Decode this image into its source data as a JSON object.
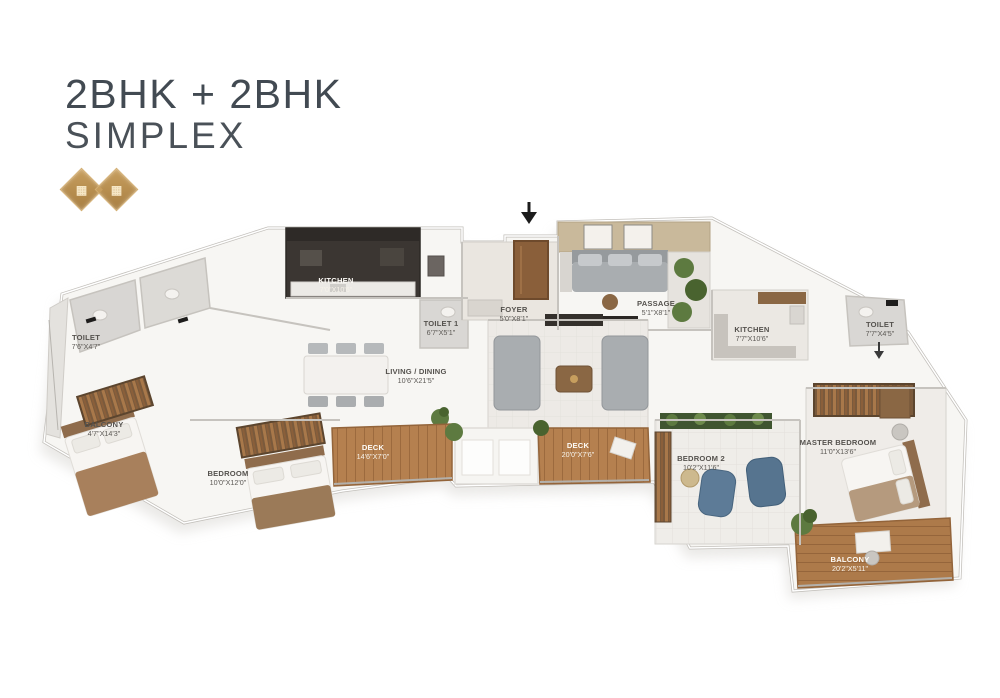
{
  "header": {
    "title_line1": "2BHK + 2BHK",
    "title_line2": "SIMPLEX",
    "badges": {
      "left_glyph": "▦",
      "separator": "◆",
      "right_glyph": "▦"
    }
  },
  "colors": {
    "title_text": "#424a52",
    "badge_gold": "#b18a4e",
    "deck_wood": "#b5804f",
    "kitchen_dark": "#3b3632",
    "wall_gray": "#c6c3be",
    "plant_green": "#5d7a40",
    "chair_blue": "#5d7b97",
    "door_brown": "#8a5f3a"
  },
  "floorplan": {
    "labels": {
      "toilet_l": {
        "name": "TOILET",
        "dim": "7'6\"X4'7\""
      },
      "balcony_l": {
        "name": "BALCONY",
        "dim": "4'7\"X14'3\""
      },
      "kitchen_l": {
        "name": "KITCHEN",
        "dim": "7'0\"X10'6\""
      },
      "toilet1": {
        "name": "TOILET 1",
        "dim": "6'7\"X5'1\""
      },
      "living_dining_l": {
        "name": "LIVING / DINING",
        "dim": "10'6\"X21'5\""
      },
      "bedroom_l": {
        "name": "BEDROOM",
        "dim": "10'0\"X12'0\""
      },
      "deck_l": {
        "name": "DECK",
        "dim": "14'6\"X7'0\""
      },
      "foyer": {
        "name": "FOYER",
        "dim": "5'0\"X8'1\""
      },
      "passage": {
        "name": "PASSAGE",
        "dim": "5'1\"X8'1\""
      },
      "deck_c": {
        "name": "DECK",
        "dim": "20'0\"X7'6\""
      },
      "kitchen_r": {
        "name": "KITCHEN",
        "dim": "7'7\"X10'6\""
      },
      "toilet_r": {
        "name": "TOILET",
        "dim": "7'7\"X4'5\""
      },
      "bedroom_r": {
        "name": "BEDROOM 2",
        "dim": "10'2\"X11'6\""
      },
      "master_bedroom": {
        "name": "MASTER BEDROOM",
        "dim": "11'0\"X13'6\""
      },
      "balcony_r": {
        "name": "BALCONY",
        "dim": "20'2\"X5'11\""
      }
    }
  }
}
